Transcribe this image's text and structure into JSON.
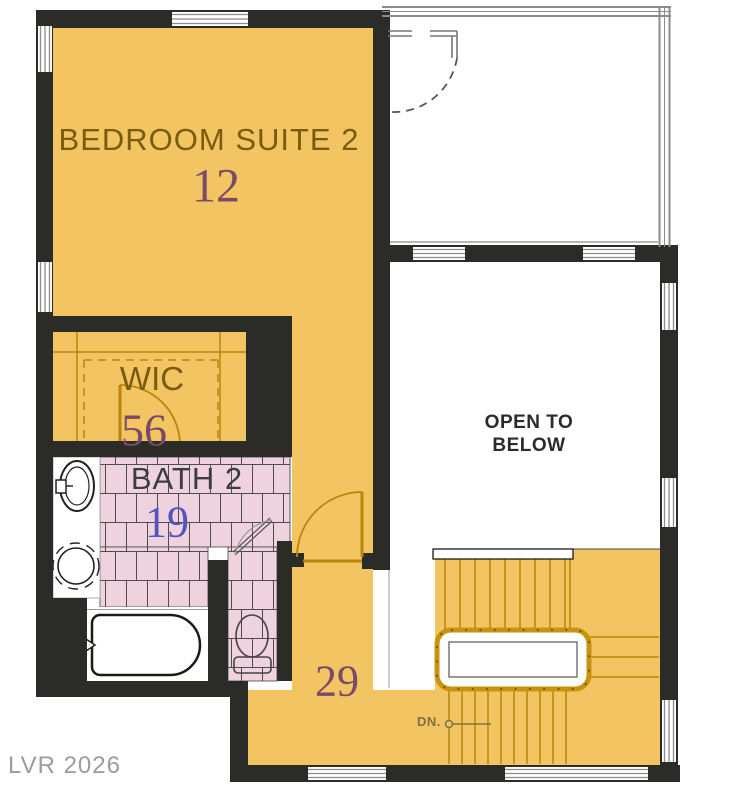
{
  "watermark": "LVR 2026",
  "rooms": {
    "bedroom": {
      "name": "BEDROOM SUITE 2",
      "number": "12"
    },
    "wic": {
      "name": "WIC",
      "number": "56"
    },
    "bath": {
      "name": "BATH 2",
      "number": "19"
    },
    "open_to_below": {
      "line1": "OPEN TO",
      "line2": "BELOW"
    },
    "stair_hall": {
      "number": "29"
    },
    "stairs": {
      "down_label": "DN."
    }
  },
  "palette": {
    "floor_orange": "#F3C462",
    "wall_black": "#2B2B28",
    "tile_pink": "#EED2DE",
    "tile_grout": "#4D4D4D",
    "trim_dark_orange": "#B8860B",
    "railing_orange": "#C8930F",
    "window_gray": "#8C8C8C",
    "room_label_brown": "#7A5C10",
    "number_mauve": "#7B4A68",
    "number_blue": "#5553C0",
    "bath_label_gray": "#3C3C46",
    "open_below_text": "#2B2B2B",
    "down_label_olive": "#837045",
    "watermark_gray": "#9C9C9C"
  },
  "icons": {
    "sink": "sink-icon",
    "water_closet": "water-closet-icon",
    "toilet": "toilet-icon",
    "bathtub": "bathtub-icon",
    "door_swing": "door-swing-icon",
    "stairs_up": "stairs-up-icon",
    "stairs_down": "stairs-down-icon"
  }
}
